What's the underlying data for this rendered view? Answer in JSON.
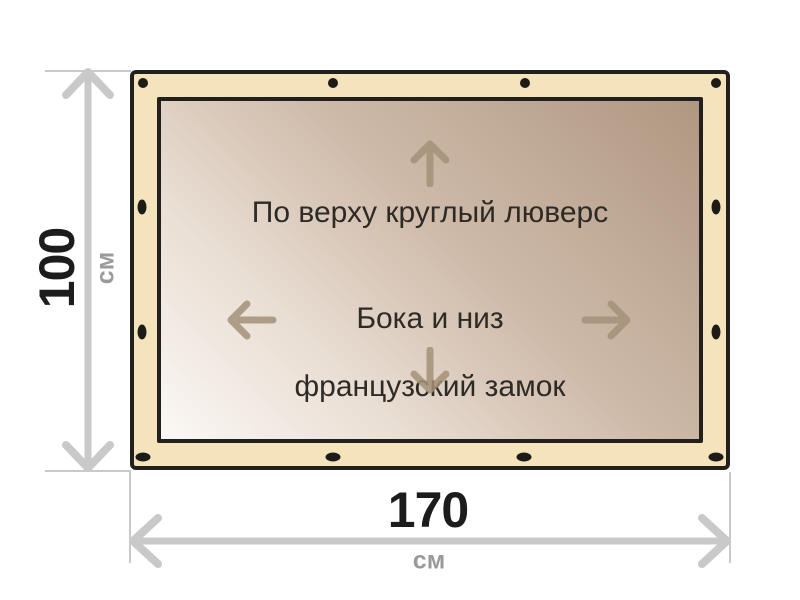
{
  "diagram": {
    "annotations": {
      "top": "По верху круглый люверс",
      "center_line1": "Бока и низ",
      "center_line2": "французский замок"
    },
    "dimensions": {
      "height": {
        "value": "100",
        "unit": "см"
      },
      "width": {
        "value": "170",
        "unit": "см"
      }
    },
    "icons": {
      "up": "arrow-up-icon",
      "down": "arrow-down-icon",
      "left": "arrow-left-icon",
      "right": "arrow-right-icon",
      "grommet": "grommet-dot-icon",
      "height_dim": "double-arrow-vertical-icon",
      "width_dim": "double-arrow-horizontal-icon"
    },
    "colors": {
      "frame_fill": "#f4e3bb",
      "frame_border": "#22201d",
      "canvas_gradient_light": "#fbf8f5",
      "canvas_gradient_dark": "#af9882",
      "dimension_line": "#c9c9c9",
      "dimension_value_text": "#1c1c1c",
      "dimension_unit_text": "#9a9a9a",
      "annotation_text": "#2e2a26",
      "annotation_arrow": "#a39178",
      "grommet": "#1d1b18",
      "background": "#ffffff"
    }
  }
}
